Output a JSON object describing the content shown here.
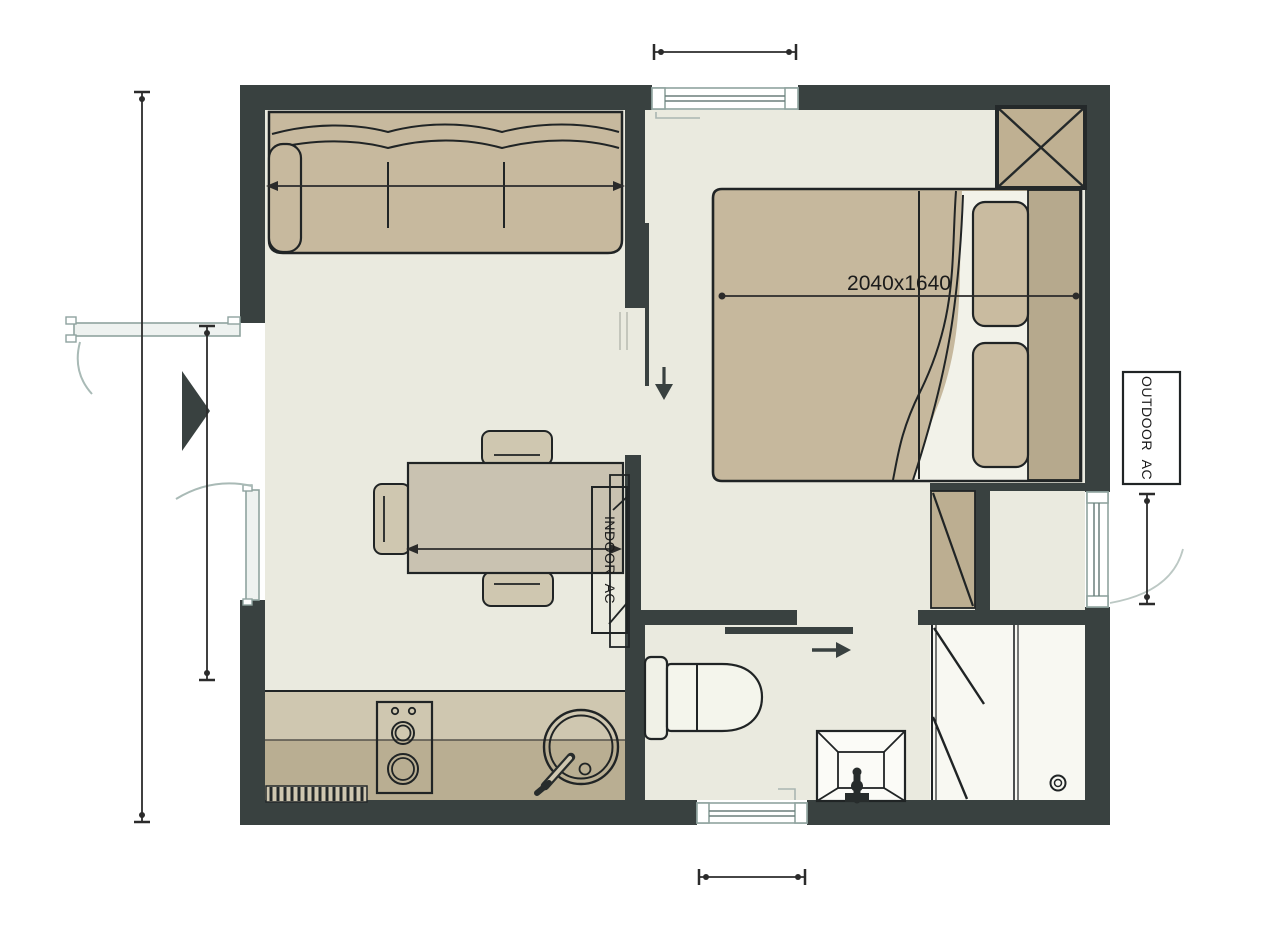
{
  "plan": {
    "type": "floor-plan",
    "labels": {
      "bed_dimension": "2040x1640",
      "indoor_ac": "INDOOR AC",
      "outdoor_ac": "OUTDOOR AC"
    },
    "fixtures": [
      "sofa",
      "dining-table",
      "chairs",
      "double-bed",
      "pillows",
      "wardrobe",
      "storage-closet",
      "kitchen-counter",
      "cooktop",
      "kitchen-sink",
      "toilet",
      "washbasin",
      "shower",
      "indoor-ac-unit",
      "outdoor-ac-unit",
      "entry-door",
      "window-top",
      "window-bottom",
      "side-door-right",
      "sliding-door-bedroom",
      "sliding-door-bathroom"
    ],
    "colors": {
      "background": "#ffffff",
      "wall": "#394140",
      "outline": "#202425",
      "floor": "#eaeadf",
      "furniture_tan": "#c7b99e",
      "furniture_tan_dark": "#b6a98d",
      "pillow_tan": "#c9bba0",
      "closet_tan": "#bcae91",
      "counter_light": "#cfc7b0",
      "counter_dark": "#b9ae92",
      "shower_floor": "#f8f8f2",
      "frame_gray": "#8fa39f",
      "swing_arc": "#aebcba",
      "dimension": "#2b2b2b"
    }
  }
}
